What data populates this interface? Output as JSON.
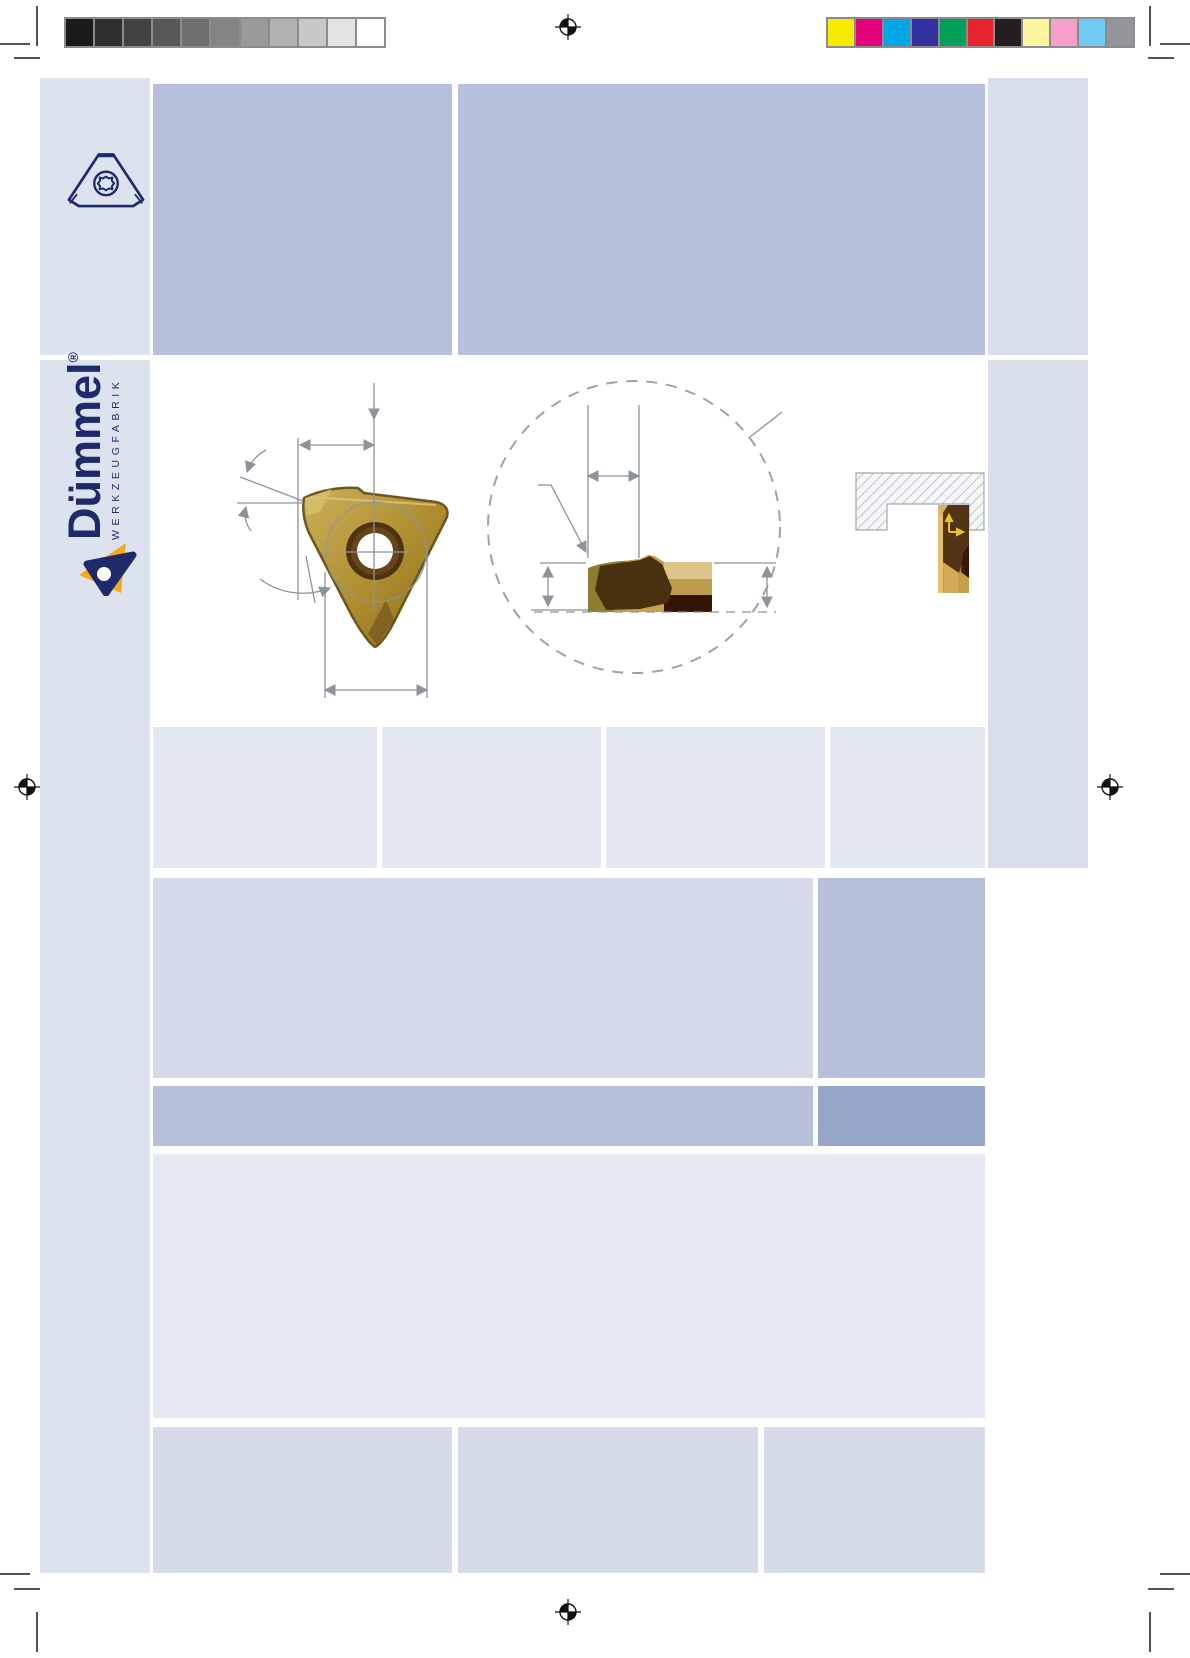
{
  "brand": {
    "name": "Dümmel",
    "registered": "®",
    "subtitle": "WERKZEUGFABRIK"
  },
  "print_marks": {
    "grayscale_steps": [
      "#1b1b1b",
      "#2f2f2f",
      "#434343",
      "#585858",
      "#6f6f6f",
      "#848484",
      "#9a9a9a",
      "#b1b1b1",
      "#c8c8c8",
      "#e3e3e3",
      "#ffffff"
    ],
    "color_bar": [
      "#f7ec00",
      "#e5007d",
      "#00a7e7",
      "#33309f",
      "#00a05a",
      "#e8222d",
      "#231f20",
      "#fbf5a0",
      "#f5a0c8",
      "#70cbf4",
      "#939598"
    ]
  },
  "colors": {
    "navy": "#1f2a6b",
    "brand_yellow": "#f6a81c",
    "sidebar": "#dde2ef",
    "sidebar_right": "#d9deec",
    "band_medium": "#b6c0db",
    "row_light": "#e3e7f1",
    "sec_left": "#d4dae9",
    "dark_band_right": "#96a5c8",
    "pale": "#e6e9f4",
    "bottom_row": "#d5dbe9",
    "dim_gray": "#8d939b",
    "insert_gold": "#b3912f"
  }
}
